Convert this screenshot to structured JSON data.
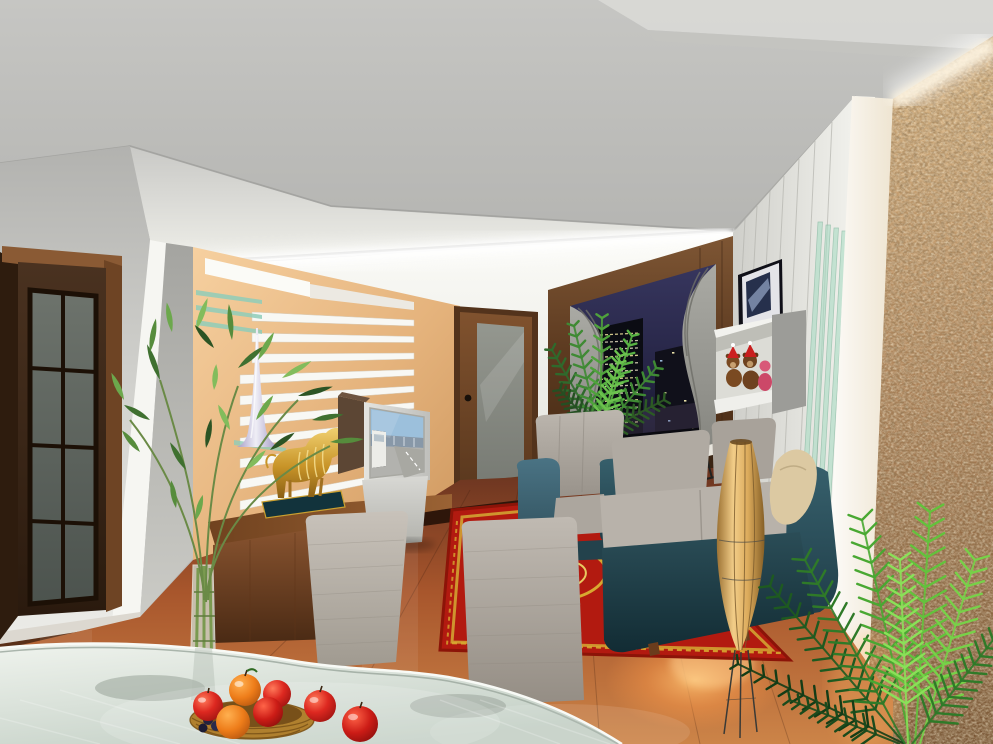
{
  "meta": {
    "title": "Living room interior - 3D architectural rendering",
    "render_style": "photorealistic 3D visualization, evening lighting",
    "view": "from glass dining table looking toward living area, night city outside window"
  },
  "scene": {
    "regions": [
      {
        "name": "ceiling",
        "description": "angled white-gray ceiling planes with indirect cove lighting"
      },
      {
        "name": "french-door",
        "description": "dark wood door with 8 smoked glass panes, left wall"
      },
      {
        "name": "feature-slat-wall",
        "description": "peach accent wall with white horizontal slats, glass shelves and tall silver vase"
      },
      {
        "name": "golden-bull-statue",
        "description": "gold bull figurine on dark base on wooden sideboard"
      },
      {
        "name": "tv",
        "description": "light gray television on pedestal showing daytime city street"
      },
      {
        "name": "interior-door",
        "description": "brown wood door with frosted glass panel"
      },
      {
        "name": "window",
        "description": "dark wood framed window, gray drapes, night skyline with lit towers"
      },
      {
        "name": "seating",
        "description": "teal-and-gray armchair, sofa with beige pillow, black chaise longue"
      },
      {
        "name": "paper-floor-lamp",
        "description": "tan tapered paper lamp on wire legs with warm floor glow"
      },
      {
        "name": "oriental-rug",
        "description": "red rug with gold ornamental border"
      },
      {
        "name": "right-wall",
        "description": "white paneled wall, tilted picture frame, box shelf with teddy bears, green glass strips"
      },
      {
        "name": "stone-wall",
        "description": "rough tan stone feature wall, washed by light"
      },
      {
        "name": "plants",
        "description": "bamboo plant at left, palm by window, large palm at right"
      },
      {
        "name": "dining",
        "description": "frosted glass table, two upholstered chairs, wicker basket of apples and oranges"
      }
    ]
  },
  "palette": {
    "ceiling_gray": "#bcbcba",
    "wall_light": "#e9e9e5",
    "back_wall": "#f7f7f3",
    "accent_tan": "#e9b97e",
    "wood_dark": "#4a2c18",
    "wood_mid": "#7a4a28",
    "wood_light": "#9a6636",
    "door_dark": "#32200f",
    "glass_smoke": "#5f6761",
    "floor_brown": "#9a4f28",
    "rug_red": "#b21a10",
    "rug_gold": "#d2a232",
    "sofa_teal": "#2c4e58",
    "cushion_gray": "#aea8a0",
    "chair_gray": "#b5afa7",
    "lamp_tan": "#e3b469",
    "stone_tan": "#b89468",
    "plant_green": "#4e8c34",
    "plant_bright": "#6cc832",
    "night_sky": "#2c2b4e",
    "city_light": "#e8d890",
    "fruit_red": "#cc2018",
    "fruit_orange": "#ee7d1a",
    "vase_lilac": "#b9b2d6",
    "glass_green": "#a8d8c0",
    "glass_table": "#dfe9e1",
    "pillow_beige": "#d8c8a4",
    "bear_brown": "#7a4a20",
    "bear_pink": "#cc4868"
  }
}
